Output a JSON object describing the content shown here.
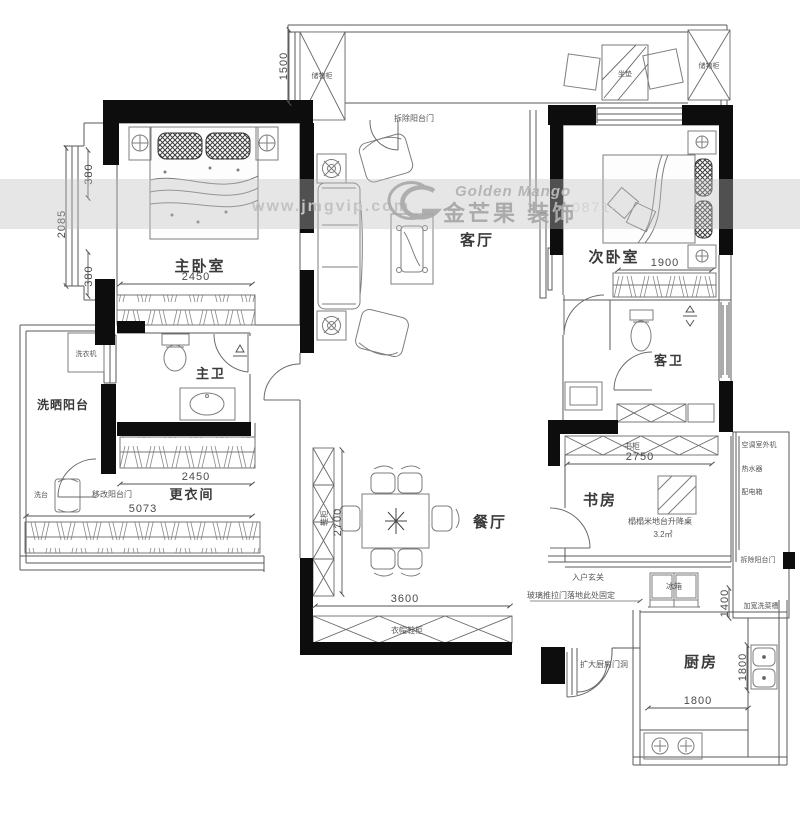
{
  "watermark": {
    "url": "www.jmgvip.com",
    "brand_en": "Golden Mango",
    "brand_cn": "金芒果 装饰",
    "phone_partial": "0871-"
  },
  "labels": {
    "master_bedroom": "主卧室",
    "second_bedroom": "次卧室",
    "living_room": "客厅",
    "dining_room": "餐厅",
    "kitchen": "厨房",
    "study": "书房",
    "master_bath": "主卫",
    "guest_bath": "客卫",
    "laundry_balcony": "洗晒阳台",
    "dressing_room": "更衣间"
  },
  "annotations": {
    "remove_balcony_door_top": "拆除阳台门",
    "storage_left": "储物柜",
    "storage_right": "储物柜",
    "cushion": "坐垫",
    "washing_machine": "洗衣机",
    "wash_stand": "洗台",
    "modify_balcony_door": "移改阳台门",
    "shoe_cabinet": "鞋柜",
    "coat_shoe_cabinet": "衣帽鞋柜",
    "entry_foyer": "入户玄关",
    "glass_door_note": "玻璃推拉门落地此处固定",
    "enlarge_kitchen_door": "扩大厨房门洞",
    "fridge": "冰箱",
    "bookcase": "书柜",
    "tatami_desk": "榻榻米地台升降桌",
    "tatami_area": "3.2㎡",
    "ac_outdoor_unit": "空调室外机",
    "water_heater": "热水器",
    "distribution_box": "配电箱",
    "remove_balcony_door_right": "拆除阳台门",
    "widen_sink": "加宽洗菜槽"
  },
  "dimensions": {
    "d1500": "1500",
    "d380a": "380",
    "d2085": "2085",
    "d380b": "380",
    "d2450a": "2450",
    "d2450b": "2450",
    "d5073": "5073",
    "d2700": "2700",
    "d3600": "3600",
    "d1900": "1900",
    "d2750": "2750",
    "d1400": "1400",
    "d1800v": "1800",
    "d1800h": "1800"
  }
}
